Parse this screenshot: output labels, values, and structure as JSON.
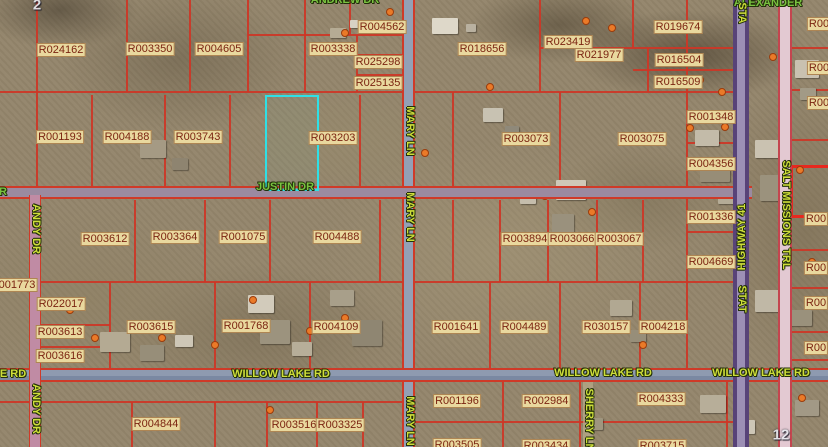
{
  "map_view": {
    "selected_parcel_color": "#2ee0e6",
    "parcel_line_color": "#cd3626",
    "parcel_label_style": {
      "text_color": "#7b2411",
      "background": "#e9d89e"
    },
    "section_labels": [
      {
        "text": "2",
        "x": 37,
        "y": 5
      },
      {
        "text": "12",
        "x": 781,
        "y": 435
      }
    ],
    "parcels": [
      {
        "text": "R024162",
        "x": 61,
        "y": 50
      },
      {
        "text": "R003350",
        "x": 150,
        "y": 49
      },
      {
        "text": "R004605",
        "x": 219,
        "y": 49
      },
      {
        "text": "R003338",
        "x": 333,
        "y": 49
      },
      {
        "text": "R004562",
        "x": 382,
        "y": 27
      },
      {
        "text": "R025298",
        "x": 378,
        "y": 62
      },
      {
        "text": "R025135",
        "x": 378,
        "y": 83
      },
      {
        "text": "R018656",
        "x": 482,
        "y": 49
      },
      {
        "text": "R023419",
        "x": 568,
        "y": 42
      },
      {
        "text": "R021977",
        "x": 599,
        "y": 55
      },
      {
        "text": "R019674",
        "x": 678,
        "y": 27
      },
      {
        "text": "R016504",
        "x": 679,
        "y": 60
      },
      {
        "text": "R016509",
        "x": 678,
        "y": 82
      },
      {
        "text": "R001348",
        "x": 711,
        "y": 117
      },
      {
        "text": "R004356",
        "x": 711,
        "y": 164
      },
      {
        "text": "R001336",
        "x": 711,
        "y": 217
      },
      {
        "text": "R004669",
        "x": 711,
        "y": 262
      },
      {
        "text": "R003073",
        "x": 526,
        "y": 139
      },
      {
        "text": "R003075",
        "x": 642,
        "y": 139
      },
      {
        "text": "R001193",
        "x": 60,
        "y": 137
      },
      {
        "text": "R004188",
        "x": 127,
        "y": 137
      },
      {
        "text": "R003743",
        "x": 198,
        "y": 137
      },
      {
        "text": "R003203",
        "x": 333,
        "y": 138
      },
      {
        "text": "R003612",
        "x": 105,
        "y": 239
      },
      {
        "text": "R003364",
        "x": 175,
        "y": 237
      },
      {
        "text": "R001075",
        "x": 243,
        "y": 237
      },
      {
        "text": "R004488",
        "x": 337,
        "y": 237
      },
      {
        "text": "R003894",
        "x": 525,
        "y": 239
      },
      {
        "text": "R003066",
        "x": 572,
        "y": 239
      },
      {
        "text": "R003067",
        "x": 619,
        "y": 239
      },
      {
        "text": "R022017",
        "x": 61,
        "y": 304
      },
      {
        "text": "R003613",
        "x": 60,
        "y": 332
      },
      {
        "text": "R003616",
        "x": 60,
        "y": 356
      },
      {
        "text": "R003615",
        "x": 151,
        "y": 327
      },
      {
        "text": "R001768",
        "x": 246,
        "y": 326
      },
      {
        "text": "R004109",
        "x": 336,
        "y": 327
      },
      {
        "text": "R001641",
        "x": 456,
        "y": 327
      },
      {
        "text": "R004489",
        "x": 524,
        "y": 327
      },
      {
        "text": "R030157",
        "x": 606,
        "y": 327
      },
      {
        "text": "R004218",
        "x": 663,
        "y": 327
      },
      {
        "text": "R004844",
        "x": 156,
        "y": 424
      },
      {
        "text": "R003516",
        "x": 294,
        "y": 425
      },
      {
        "text": "R003325",
        "x": 340,
        "y": 425
      },
      {
        "text": "R001196",
        "x": 457,
        "y": 401
      },
      {
        "text": "R002984",
        "x": 546,
        "y": 401
      },
      {
        "text": "R004333",
        "x": 661,
        "y": 399
      },
      {
        "text": "R003505",
        "x": 457,
        "y": 445
      },
      {
        "text": "R003434",
        "x": 546,
        "y": 446
      },
      {
        "text": "R003715",
        "x": 662,
        "y": 446
      }
    ],
    "edge_parcel_fragments": [
      {
        "text": "001773",
        "x": 17,
        "y": 285
      },
      {
        "text": "R00",
        "x": 819,
        "y": 24
      },
      {
        "text": "R00",
        "x": 819,
        "y": 68
      },
      {
        "text": "R00",
        "x": 819,
        "y": 103
      },
      {
        "text": "R00",
        "x": 816,
        "y": 219
      },
      {
        "text": "R00",
        "x": 816,
        "y": 268
      },
      {
        "text": "R00",
        "x": 816,
        "y": 303
      },
      {
        "text": "R00",
        "x": 816,
        "y": 348
      }
    ],
    "road_labels_horizontal": [
      {
        "text": "ANDREW DR",
        "x": 345,
        "y": 0,
        "tone": "green"
      },
      {
        "text": "ALEXANDER",
        "x": 768,
        "y": 3,
        "tone": "green"
      },
      {
        "text": "JUSTIN DR",
        "x": 285,
        "y": 187,
        "tone": "green"
      },
      {
        "text": "R",
        "x": 3,
        "y": 192,
        "tone": "green"
      },
      {
        "text": "E RD",
        "x": 13,
        "y": 374,
        "tone": "chartreuse"
      },
      {
        "text": "WILLOW LAKE RD",
        "x": 281,
        "y": 374,
        "tone": "chartreuse"
      },
      {
        "text": "WILLOW LAKE RD",
        "x": 603,
        "y": 373,
        "tone": "chartreuse"
      },
      {
        "text": "WILLOW LAKE RD",
        "x": 761,
        "y": 373,
        "tone": "chartreuse"
      }
    ],
    "road_labels_vertical": [
      {
        "text": "MARY LN",
        "x": 410,
        "y": 131,
        "tone": "chartreuse",
        "flip": false
      },
      {
        "text": "MARY LN",
        "x": 410,
        "y": 217,
        "tone": "chartreuse",
        "flip": false
      },
      {
        "text": "MARY LN",
        "x": 410,
        "y": 421,
        "tone": "chartreuse",
        "flip": false
      },
      {
        "text": "ANDY DR",
        "x": 36,
        "y": 229,
        "tone": "chartreuse",
        "flip": false
      },
      {
        "text": "ANDY DR",
        "x": 36,
        "y": 409,
        "tone": "chartreuse",
        "flip": false
      },
      {
        "text": "SHERRY LN",
        "x": 589,
        "y": 420,
        "tone": "chartreuse",
        "flip": false
      },
      {
        "text": "SALT MISSIONS TRL",
        "x": 786,
        "y": 215,
        "tone": "chartreuse",
        "flip": false
      },
      {
        "text": "STA",
        "x": 742,
        "y": 13,
        "tone": "chartreuse",
        "flip": false
      },
      {
        "text": "HIGHWAY 41",
        "x": 742,
        "y": 237,
        "tone": "chartreuse",
        "flip": true
      },
      {
        "text": "STAT",
        "x": 742,
        "y": 299,
        "tone": "chartreuse",
        "flip": false
      }
    ],
    "road_names": [
      "ANDREW DR",
      "ALEXANDER",
      "JUSTIN DR",
      "WILLOW LAKE RD",
      "MARY LN",
      "ANDY DR",
      "SHERRY LN",
      "SALT MISSIONS TRL",
      "STATE HIGHWAY 41"
    ]
  }
}
